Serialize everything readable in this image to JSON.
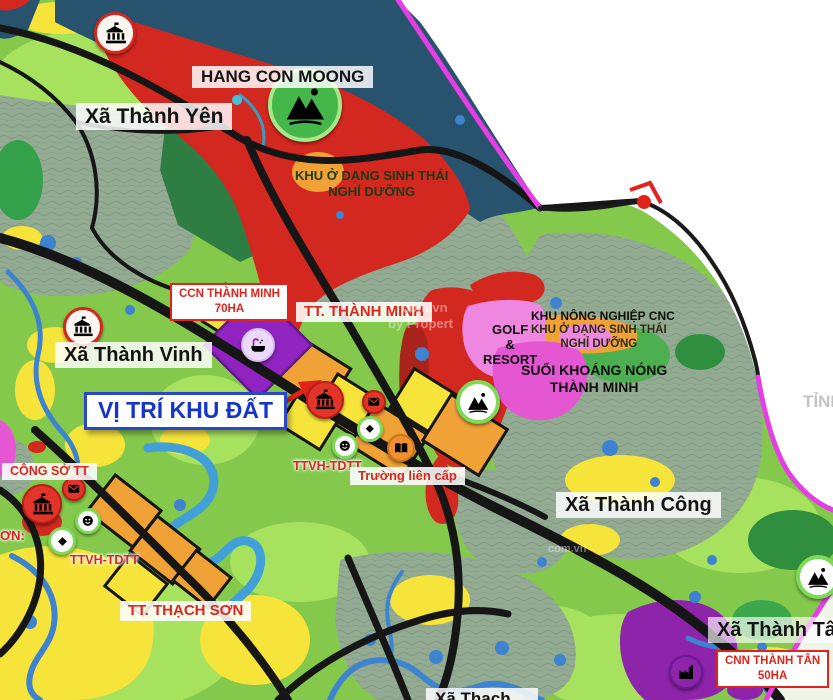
{
  "labels": {
    "hang_con_moong": "HANG CON MOONG",
    "xa_thanh_yen": "Xã Thành Yên",
    "khu_sinh_thai_north_1": "KHU Ở DẠNG SINH THÁI",
    "khu_sinh_thai_north_2": "NGHỈ DƯỠNG",
    "ccn_thanh_minh_1": "CCN THÀNH MINH",
    "ccn_thanh_minh_2": "70HA",
    "tt_thanh_minh": "TT. THÀNH MINH",
    "xa_thanh_vinh": "Xã Thành Vinh",
    "vi_tri_khu_dat": "VỊ TRÍ KHU ĐẤT",
    "golf_resort_1": "GOLF",
    "golf_resort_2": "&",
    "golf_resort_3": "RESORT",
    "khu_nong_nghiep_cnc": "KHU NÔNG NGHIỆP CNC",
    "khu_sinh_thai_east_1": "KHU Ở DẠNG SINH THÁI",
    "khu_sinh_thai_east_2": "NGHỈ DƯỠNG",
    "suoi_khoang_nong_1": "SUỐI KHOÁNG NÓNG",
    "suoi_khoang_nong_2": "THÀNH MINH",
    "tinh_partial": "TỈNH",
    "xa_thanh_cong": "Xã Thành Công",
    "ttvh_tdtt_center": "TTVH-TDTT",
    "truong_lien_cap": "Trường liên cấp",
    "cong_so_tt": "CÔNG SỞ TT",
    "son_partial": "ƠN:",
    "ttvh_tdtt_left": "TTVH-TDTT",
    "tt_thach_son": "TT. THẠCH SƠN",
    "xa_thanh_tan": "Xã Thành Tân",
    "cnn_thanh_tan_1": "CNN THÀNH TÂN",
    "cnn_thanh_tan_2": "50HA",
    "xa_thach_bottom": "Xã Thạch ..."
  },
  "watermark": {
    "line1": "com.vn",
    "line2": "by Propert"
  },
  "icon_names": [
    "government-building-icon",
    "mountain-icon",
    "envelope-icon",
    "theater-face-icon",
    "diamond-icon",
    "book-icon",
    "hot-spring-bath-icon",
    "factory-icon",
    "road-endpoint-marker"
  ],
  "colors": {
    "boundary_magenta": "#e53ee5",
    "road_black": "#161616",
    "zone_red": "#d3281f",
    "zone_orange": "#f0a237",
    "zone_yellow": "#f6e43b",
    "zone_purple": "#8e24aa",
    "zone_pink": "#ef86e0",
    "water_blue": "#3e83cf",
    "navy": "#27536e",
    "label_red": "#e0241d",
    "label_blue": "#1536c8",
    "base_green": "#84c94b",
    "gray_terrain": "#93ab93",
    "out_of_area": "#ffffff"
  }
}
